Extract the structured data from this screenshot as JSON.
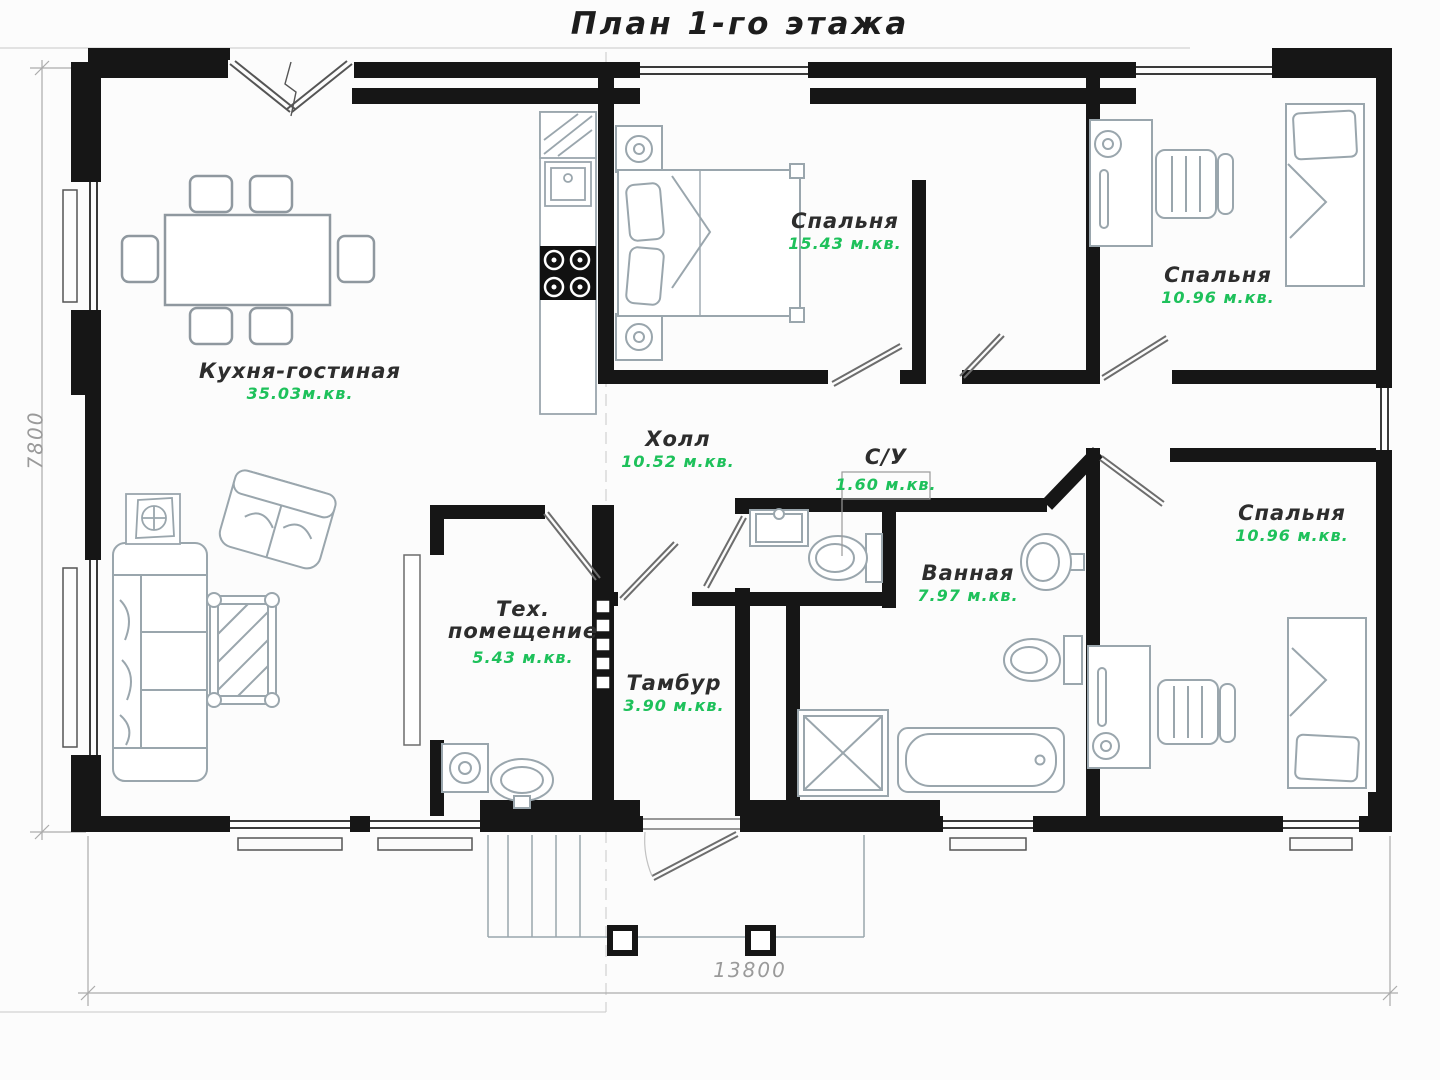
{
  "title": "План 1-го этажа",
  "dimensions": {
    "height": "7800",
    "width": "13800"
  },
  "rooms": [
    {
      "id": "kitchen-living",
      "name": "Кухня-гостиная",
      "area": "35.03м.кв."
    },
    {
      "id": "bedroom-top",
      "name": "Спальня",
      "area": "15.43 м.кв."
    },
    {
      "id": "bedroom-right-top",
      "name": "Спальня",
      "area": "10.96 м.кв."
    },
    {
      "id": "hall",
      "name": "Холл",
      "area": "10.52 м.кв."
    },
    {
      "id": "wc",
      "name": "С/У",
      "area": "1.60 м.кв."
    },
    {
      "id": "bathroom",
      "name": "Ванная",
      "area": "7.97 м.кв."
    },
    {
      "id": "tech-room",
      "name": "Тех. помещение",
      "area": "5.43 м.кв."
    },
    {
      "id": "vestibule",
      "name": "Тамбур",
      "area": "3.90 м.кв."
    },
    {
      "id": "bedroom-right-bottom",
      "name": "Спальня",
      "area": "10.96 м.кв."
    }
  ],
  "colors": {
    "walls": "#161616",
    "area_text": "#1ec15b",
    "furniture_lines": "#9aa6ad",
    "dimension_lines": "#a0a0a0"
  }
}
